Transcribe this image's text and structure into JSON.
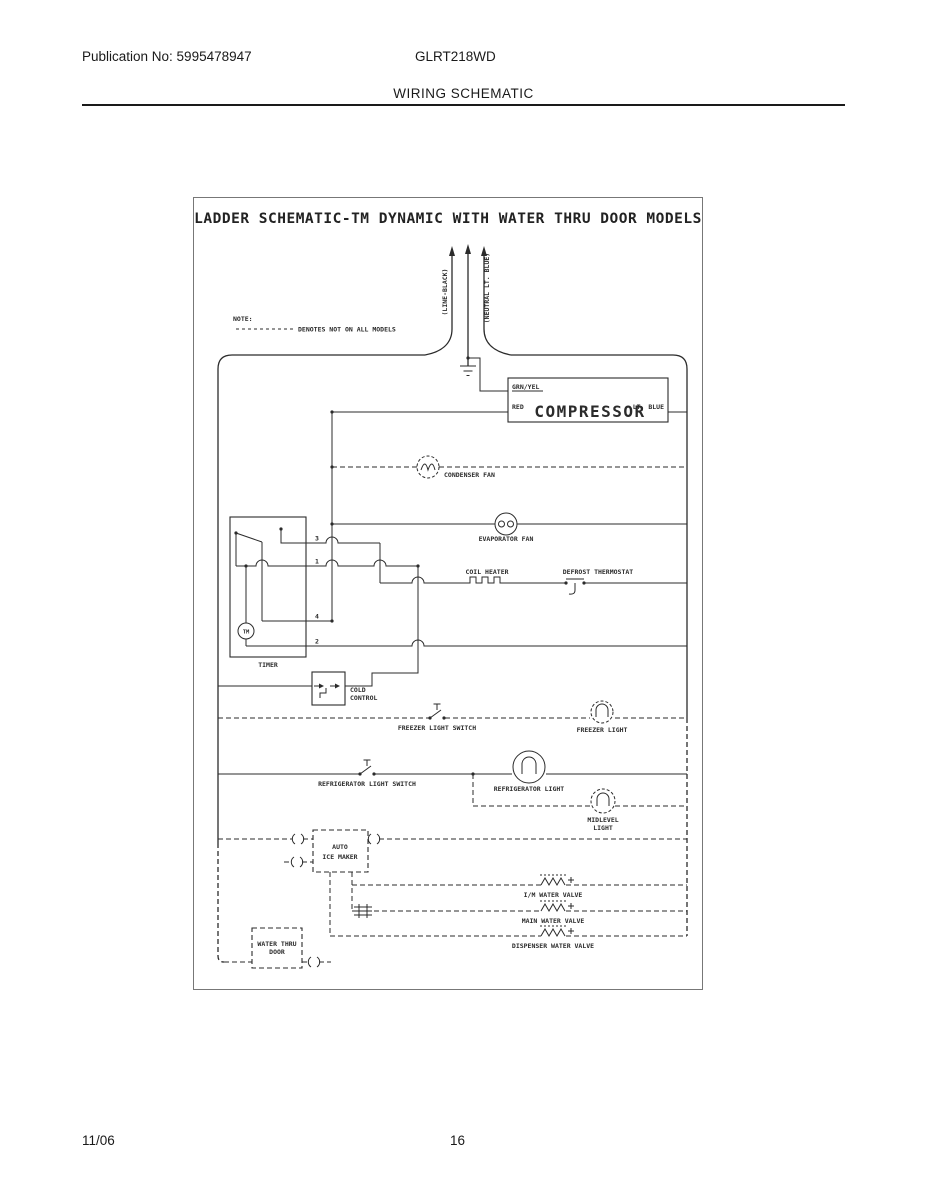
{
  "page": {
    "publication": "Publication No: 5995478947",
    "model": "GLRT218WD",
    "section_title": "WIRING SCHEMATIC",
    "footer_date": "11/06",
    "footer_page": "16"
  },
  "schematic": {
    "title": "LADDER SCHEMATIC-TM DYNAMIC WITH WATER THRU DOOR MODELS",
    "note_label": "NOTE:",
    "note_text": "DENOTES NOT ON ALL MODELS",
    "supply": {
      "line": "(LINE-BLACK)",
      "neutral": "(NEUTRAL LT. BLUE)"
    },
    "compressor": {
      "label": "COMPRESSOR",
      "grn_yel": "GRN/YEL",
      "red": "RED",
      "lt_blue": "LT. BLUE"
    },
    "timer_terminals": {
      "t3": "3",
      "t1": "1",
      "t4": "4",
      "t2": "2"
    },
    "components": {
      "condenser_fan": "CONDENSER FAN",
      "evaporator_fan": "EVAPORATOR FAN",
      "coil_heater": "COIL HEATER",
      "defrost_thermostat": "DEFROST THERMOSTAT",
      "timer": "TIMER",
      "timer_motor": "TM",
      "cold_control_1": "COLD",
      "cold_control_2": "CONTROL",
      "freezer_light_switch": "FREEZER LIGHT SWITCH",
      "freezer_light": "FREEZER LIGHT",
      "refrigerator_light_switch": "REFRIGERATOR LIGHT SWITCH",
      "refrigerator_light": "REFRIGERATOR LIGHT",
      "midlevel_light_1": "MIDLEVEL",
      "midlevel_light_2": "LIGHT",
      "ice_maker_1": "AUTO",
      "ice_maker_2": "ICE MAKER",
      "im_water_valve": "I/M WATER VALVE",
      "main_water_valve": "MAIN WATER VALVE",
      "dispenser_water_valve": "DISPENSER WATER VALVE",
      "water_thru_door_1": "WATER THRU",
      "water_thru_door_2": "DOOR"
    }
  },
  "colors": {
    "ink": "#2b2b2b",
    "paper": "#ffffff",
    "frame": "#666666"
  }
}
